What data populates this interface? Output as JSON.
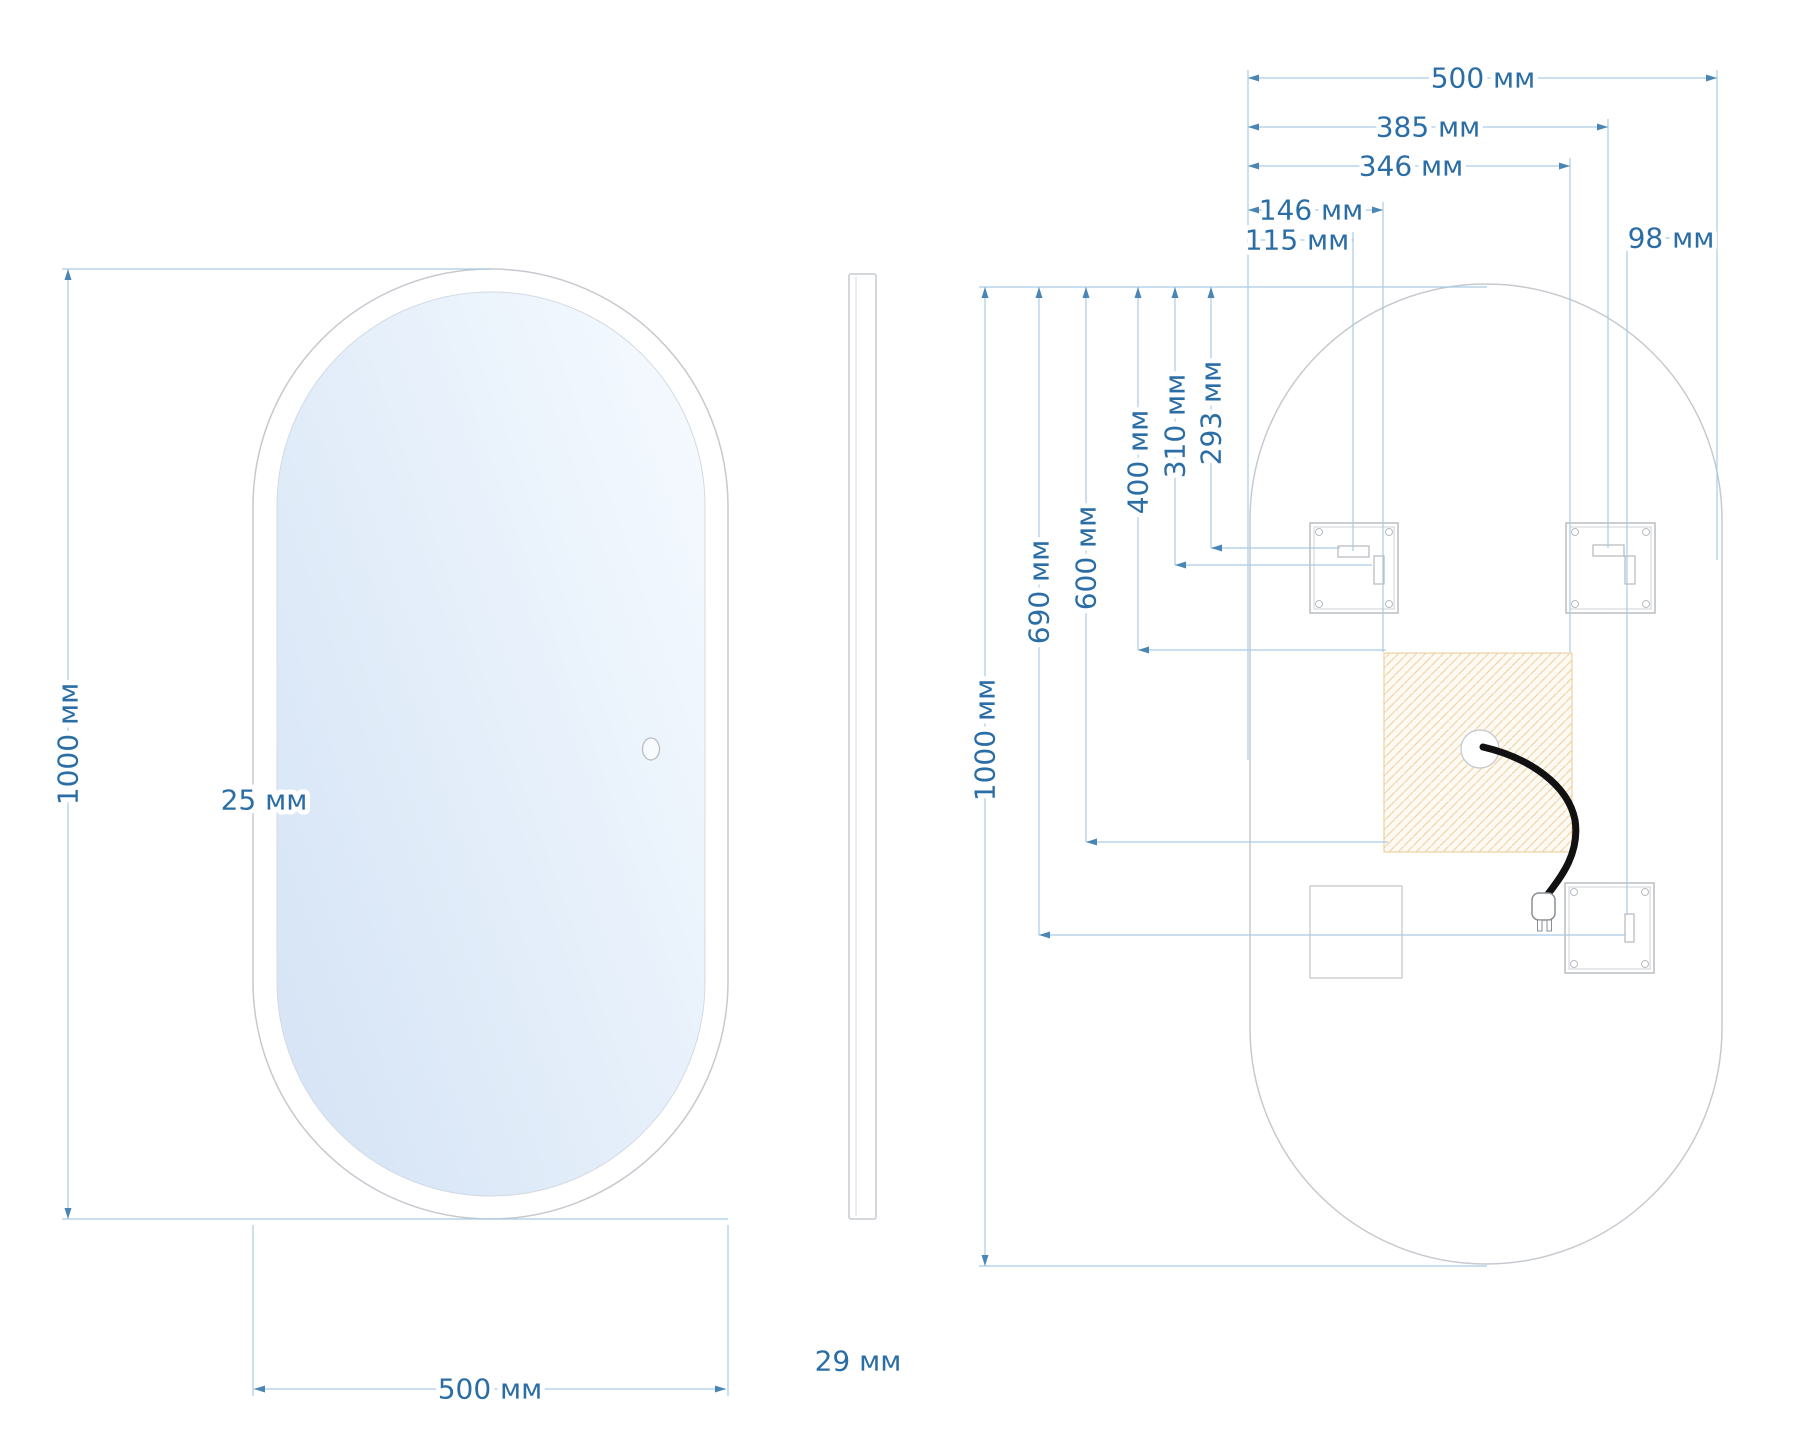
{
  "diagram": {
    "kind": "oval mirror technical drawing",
    "unit": "мм"
  },
  "front_view": {
    "height_label": "1000 мм",
    "width_label": "500 мм",
    "frame_label": "25 мм"
  },
  "side_view": {
    "thickness_label": "29 мм"
  },
  "back_view": {
    "width_label": "500 мм",
    "height_label": "1000 мм",
    "dim_385": "385 мм",
    "dim_346": "346 мм",
    "dim_146": "146 мм",
    "dim_115": "115 мм",
    "dim_98": "98 мм",
    "dim_690": "690 мм",
    "dim_600": "600 мм",
    "dim_400": "400 мм",
    "dim_310": "310 мм",
    "dim_293": "293 мм"
  },
  "colors": {
    "dimension_text": "#2b6da5",
    "dimension_line": "#a9cbe3",
    "outline": "#c6cacf",
    "heater_hatch": "#f2d7ab",
    "cable": "#111111"
  }
}
